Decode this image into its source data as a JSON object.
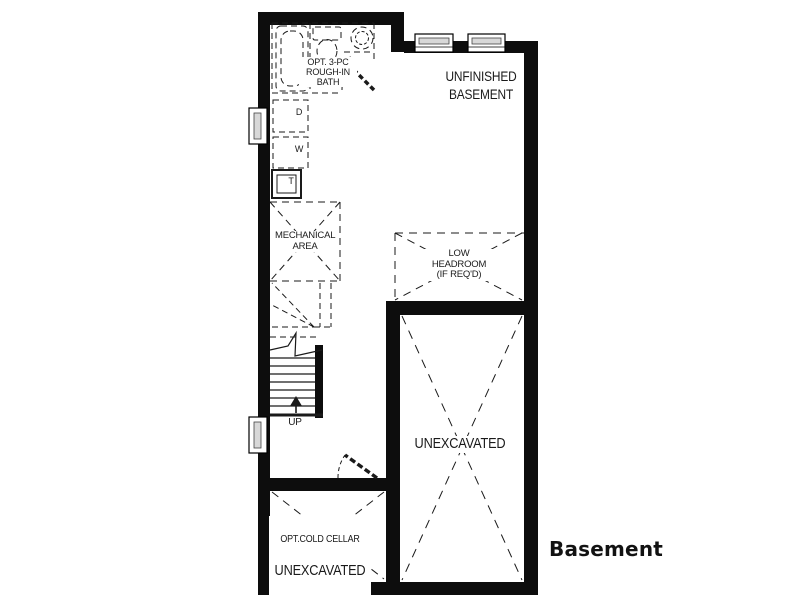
{
  "page": {
    "caption": "Basement"
  },
  "floorplan": {
    "wall_color": "#0d0d0d",
    "line_color": "#1a1a1a",
    "labels": {
      "bath": "OPT. 3-PC\nROUGH-IN\nBATH",
      "unfinished_basement": "UNFINISHED\nBASEMENT",
      "mechanical_area": "MECHANICAL\nAREA",
      "low_headroom": "LOW\nHEADROOM\n(IF REQ'D)",
      "unexcavated": "UNEXCAVATED",
      "cold_cellar_line1": "OPT.COLD CELLAR",
      "cold_cellar_line2": "UNEXCAVATED",
      "dryer": "D",
      "washer": "W",
      "tank": "T",
      "stairs_direction": "UP"
    }
  }
}
